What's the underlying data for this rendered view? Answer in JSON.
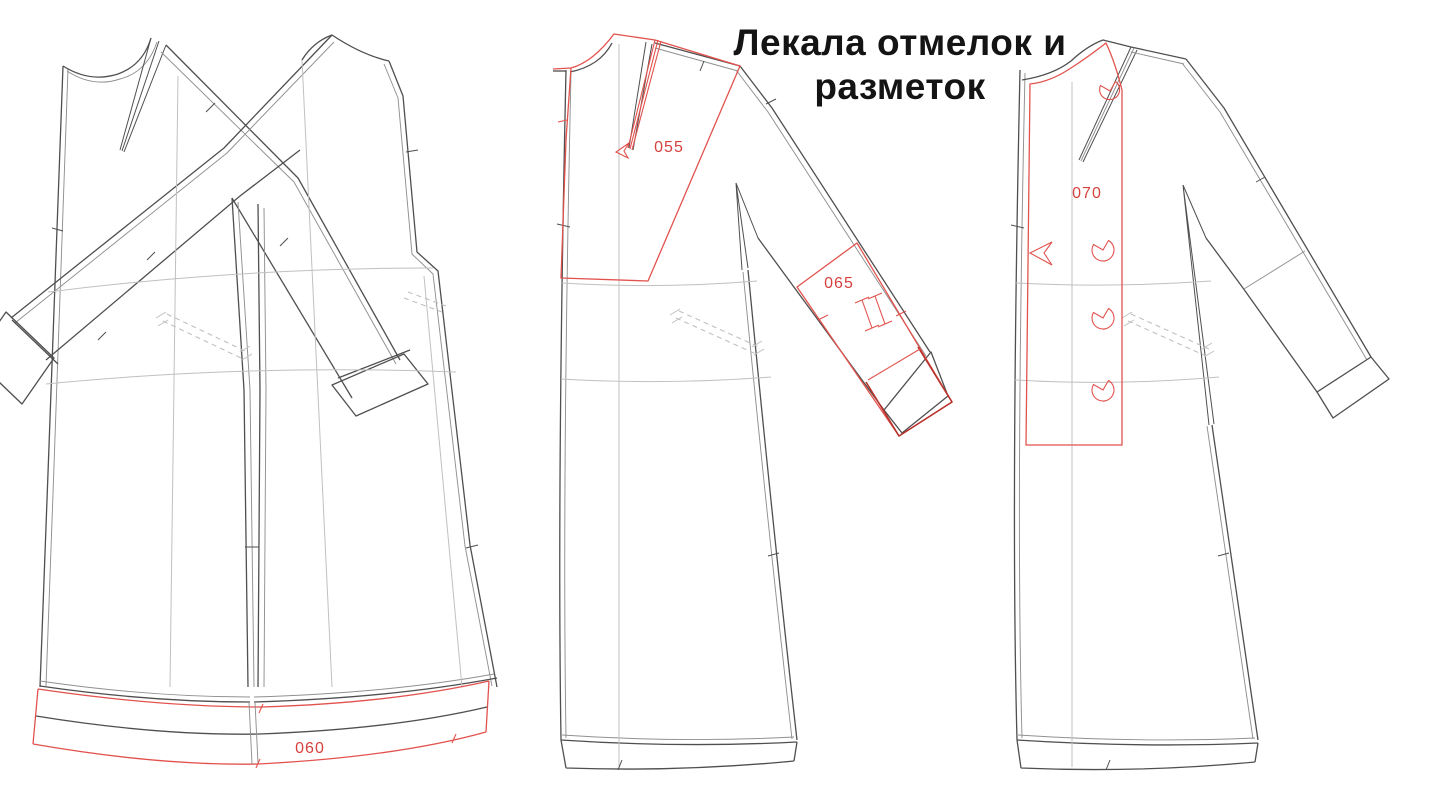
{
  "title": {
    "line1": "Лекала отмелок и",
    "line2": "разметок"
  },
  "labels": {
    "yoke_overlay": "055",
    "hem_band": "060",
    "cuff_overlay": "065",
    "placket_overlay": "070"
  },
  "colors": {
    "background": "#ffffff",
    "title_color": "#141414",
    "label_red": "#d6413d",
    "marking_red": "#e2524d",
    "marking_red_dark": "#b8322c",
    "outline_dark": "#4f4f4f",
    "outline_mid": "#909090",
    "construction_light": "#c0c0c0"
  }
}
